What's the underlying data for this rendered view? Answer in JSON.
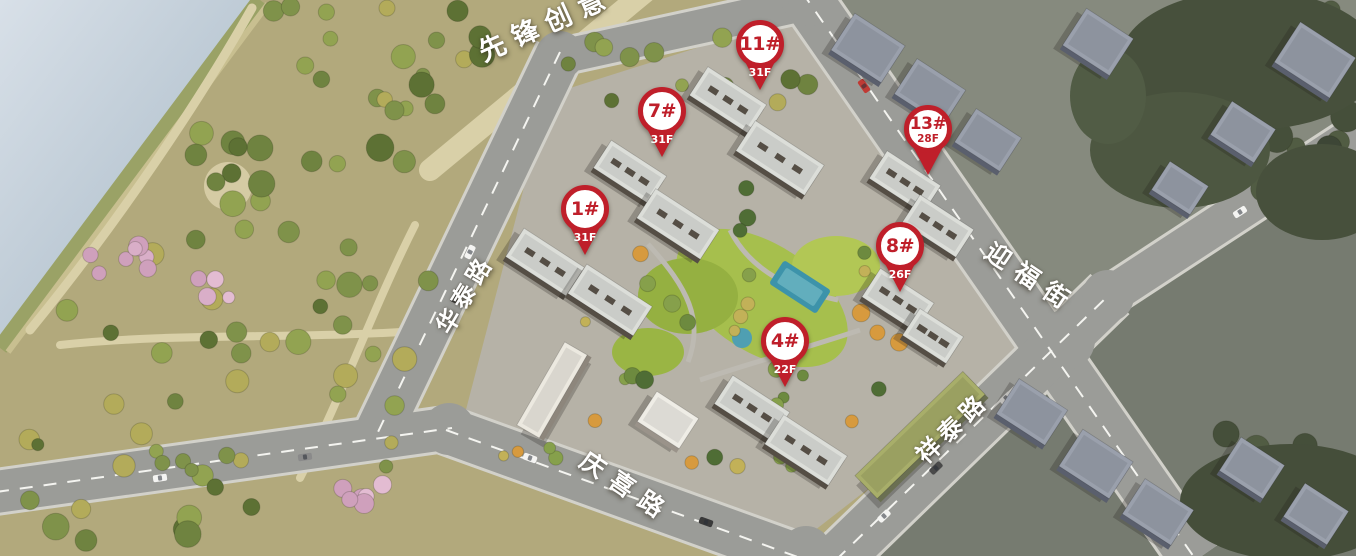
{
  "pins": [
    {
      "building": "1#",
      "floors": "31F",
      "x": 585,
      "y": 255,
      "style": "band"
    },
    {
      "building": "7#",
      "floors": "31F",
      "x": 662,
      "y": 157,
      "style": "band"
    },
    {
      "building": "11#",
      "floors": "31F",
      "x": 760,
      "y": 90,
      "style": "band"
    },
    {
      "building": "13#",
      "floors": "28F",
      "x": 928,
      "y": 175,
      "style": "circle"
    },
    {
      "building": "8#",
      "floors": "26F",
      "x": 900,
      "y": 292,
      "style": "band"
    },
    {
      "building": "4#",
      "floors": "22F",
      "x": 785,
      "y": 387,
      "style": "band"
    }
  ],
  "road_labels": [
    {
      "text": "先锋创意",
      "x": 545,
      "y": 22,
      "angle": -24,
      "size": 27,
      "spacing": 9
    },
    {
      "text": "华泰路",
      "x": 463,
      "y": 293,
      "angle": -59,
      "size": 24,
      "spacing": 5
    },
    {
      "text": "迎福街",
      "x": 1032,
      "y": 277,
      "angle": 34,
      "size": 25,
      "spacing": 10
    },
    {
      "text": "祥泰路",
      "x": 951,
      "y": 426,
      "angle": -44,
      "size": 24,
      "spacing": 6
    },
    {
      "text": "庆喜路",
      "x": 627,
      "y": 486,
      "angle": 34,
      "size": 25,
      "spacing": 10
    }
  ],
  "colors": {
    "pin_red": "#bf1f2a",
    "pin_white": "#ffffff",
    "label_text": "#ffffff"
  }
}
